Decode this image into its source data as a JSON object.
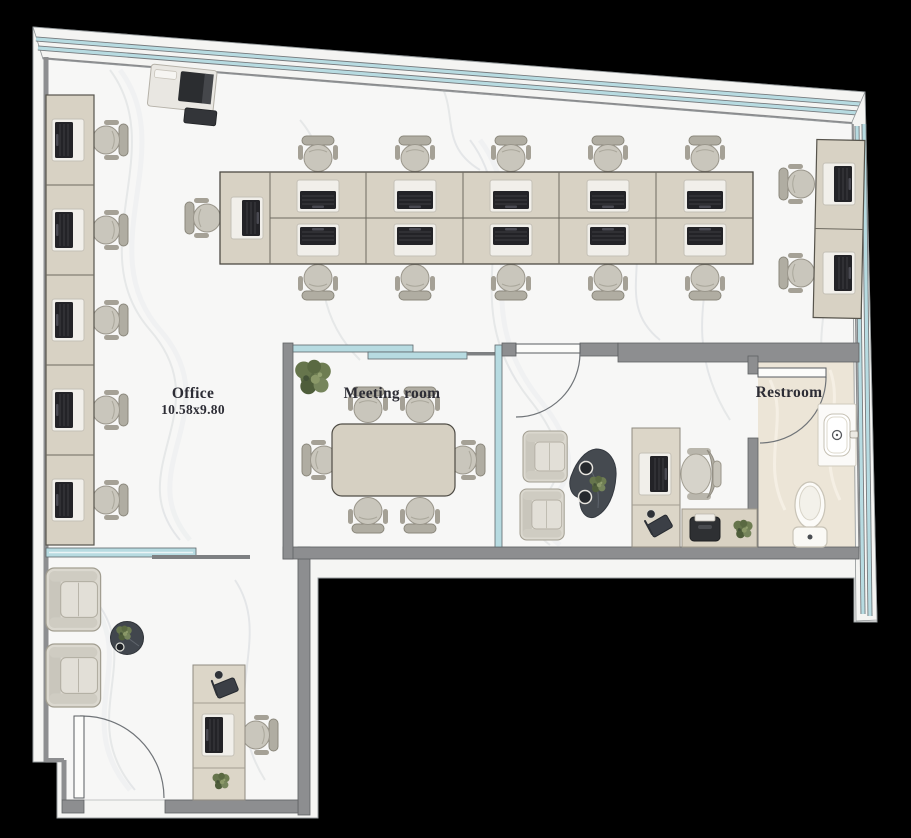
{
  "canvas": {
    "width": 911,
    "height": 838,
    "background": "#000000"
  },
  "plan": {
    "rooms": [
      {
        "id": "office",
        "label": "Office",
        "dimensions": "10.58x9.80"
      },
      {
        "id": "meeting-room",
        "label": "Meeting room"
      },
      {
        "id": "restroom",
        "label": "Restroom"
      },
      {
        "id": "executive-office"
      },
      {
        "id": "reception-lounge"
      }
    ],
    "furniture": {
      "open_office_workstations": 18,
      "workstation_groups": {
        "left_wall": 5,
        "center_bank": 11,
        "right_wall": 2
      },
      "meeting_seats": 6,
      "executive_guest_chairs": 2,
      "lounge_armchairs": 2,
      "reception_desks": 1,
      "executive_desks": 1,
      "plants": 5,
      "printers": 2,
      "coffee_tables": 2,
      "restroom_fixtures": [
        "sink",
        "toilet"
      ],
      "swing_doors": 3,
      "sliding_glass_partitions": 2
    },
    "colors": {
      "wall": "#8d8e90",
      "glass": "#b7dbe1",
      "floor": "#f7f7f6",
      "restroom_floor": "#ece5d7",
      "desk": "#d8d2c4",
      "chair": "#c9c6bc",
      "laptop_keyboard": "#232327",
      "plant": "#5c6b45",
      "coffee_table": "#41464d"
    }
  }
}
